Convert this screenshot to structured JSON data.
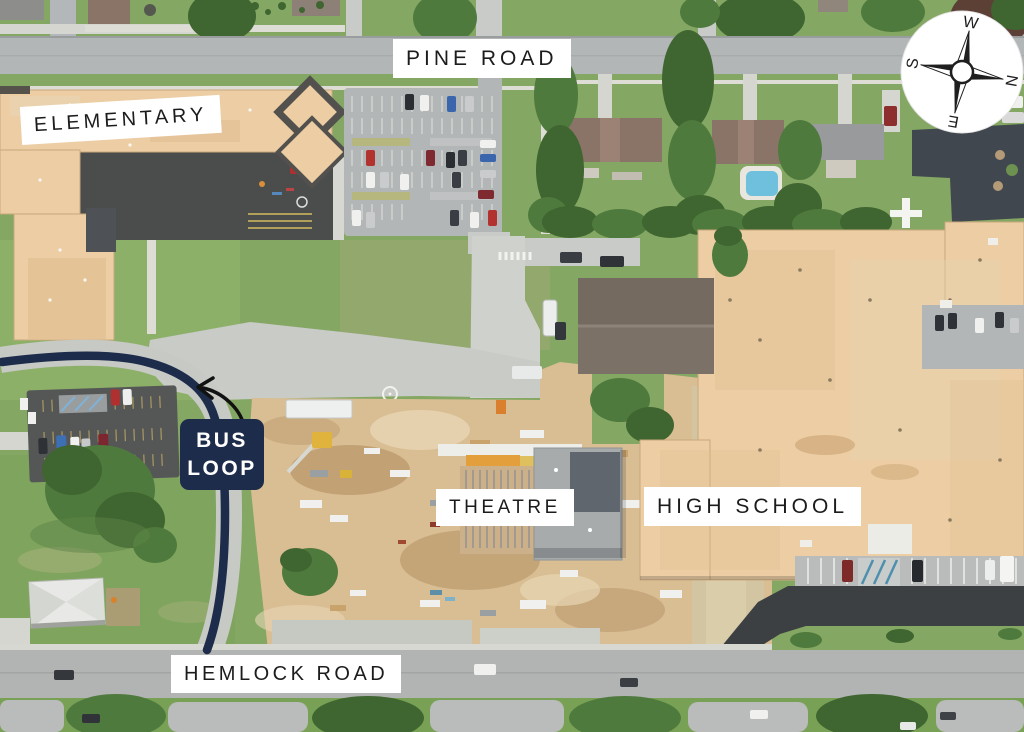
{
  "map": {
    "road_labels": {
      "pine": "PINE ROAD",
      "hemlock": "HEMLOCK ROAD"
    },
    "building_labels": {
      "elementary": "ELEMENTARY",
      "theatre": "THEATRE",
      "high_school": "HIGH SCHOOL"
    },
    "bus_loop": {
      "line1": "BUS",
      "line2": "LOOP"
    },
    "compass": {
      "n": "N",
      "e": "E",
      "s": "S",
      "w": "W"
    },
    "colors": {
      "navy": "#1d2c4a",
      "label_bg": "#ffffff",
      "label_text": "#1c1c1c",
      "arrow": "#111111"
    }
  }
}
